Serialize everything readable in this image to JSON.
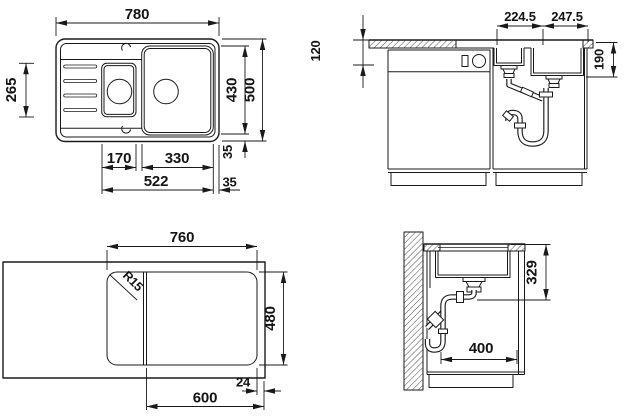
{
  "colors": {
    "line": "#1a1a1a",
    "background": "#ffffff"
  },
  "views": {
    "sink_top_view": {
      "overall_width": "780",
      "overall_depth": "500",
      "bowl_zone_depth": "430",
      "drainer_span": "265",
      "small_bowl_width": "170",
      "main_bowl_width": "330",
      "bowls_total_width": "522",
      "right_offset": "35",
      "bottom_offset": "35"
    },
    "front_view": {
      "small_bowl_center_dist": "224.5",
      "main_bowl_center_dist": "247.5",
      "counter_height": "120",
      "bowl_depth": "190"
    },
    "cutout_view": {
      "cutout_width": "760",
      "cutout_depth": "480",
      "corner_radius": "R15",
      "cabinet_width": "600",
      "front_gap": "24"
    },
    "side_view": {
      "clearance_below_top": "329",
      "cabinet_clear_depth": "400"
    }
  }
}
